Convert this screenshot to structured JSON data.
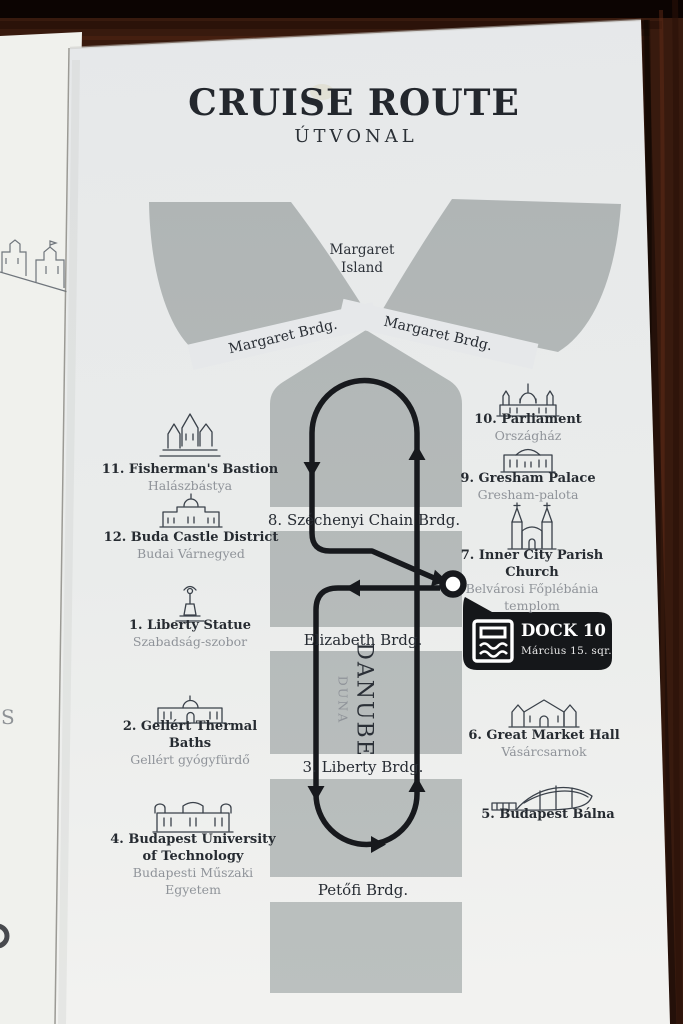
{
  "header": {
    "title": "CRUISE ROUTE",
    "subtitle": "ÚTVONAL"
  },
  "island": {
    "lines": [
      "Margaret",
      "Island"
    ]
  },
  "river": {
    "name": "DANUBE",
    "name_local": "DUNA"
  },
  "bridges": {
    "margaret_left": "Margaret Brdg.",
    "margaret_right": "Margaret Brdg.",
    "chain": "8. Széchenyi Chain Brdg.",
    "elizabeth": "Elizabeth Brdg.",
    "liberty": "3. Liberty Brdg.",
    "petofi": "Petőfi Brdg."
  },
  "dock": {
    "label": "DOCK 10",
    "sublabel": "Március 15. sqr."
  },
  "landmarks_left": [
    {
      "icon": "fishermans-bastion-icon",
      "name_lines": [
        "11. Fisherman's Bastion"
      ],
      "local_lines": [
        "Halászbástya"
      ]
    },
    {
      "icon": "buda-castle-icon",
      "name_lines": [
        "12. Buda Castle District"
      ],
      "local_lines": [
        "Budai Várnegyed"
      ]
    },
    {
      "icon": "liberty-statue-icon",
      "name_lines": [
        "1. Liberty Statue"
      ],
      "local_lines": [
        "Szabadság-szobor"
      ]
    },
    {
      "icon": "gellert-baths-icon",
      "name_lines": [
        "2. Gellért Thermal",
        "Baths"
      ],
      "local_lines": [
        "Gellért gyógyfürdő"
      ]
    },
    {
      "icon": "technical-university-icon",
      "name_lines": [
        "4. Budapest University",
        "of Technology"
      ],
      "local_lines": [
        "Budapesti Műszaki",
        "Egyetem"
      ]
    }
  ],
  "landmarks_right": [
    {
      "icon": "parliament-icon",
      "name_lines": [
        "10. Parliament"
      ],
      "local_lines": [
        "Országház"
      ]
    },
    {
      "icon": "gresham-palace-icon",
      "name_lines": [
        "9. Gresham Palace"
      ],
      "local_lines": [
        "Gresham-palota"
      ]
    },
    {
      "icon": "inner-city-parish-church-icon",
      "name_lines": [
        "7. Inner City Parish",
        "Church"
      ],
      "local_lines": [
        "Belvárosi Főplébánia",
        "templom"
      ]
    },
    {
      "icon": "great-market-hall-icon",
      "name_lines": [
        "6. Great Market Hall"
      ],
      "local_lines": [
        "Vásárcsarnok"
      ]
    },
    {
      "icon": "budapest-balna-icon",
      "name_lines": [
        "5. Budapest Bálna"
      ],
      "local_lines": []
    }
  ],
  "colors": {
    "route": "#17191d",
    "river": "#b5bab9",
    "badge": "#15171a",
    "page": "#eaecee",
    "wood": "#381a0e"
  }
}
